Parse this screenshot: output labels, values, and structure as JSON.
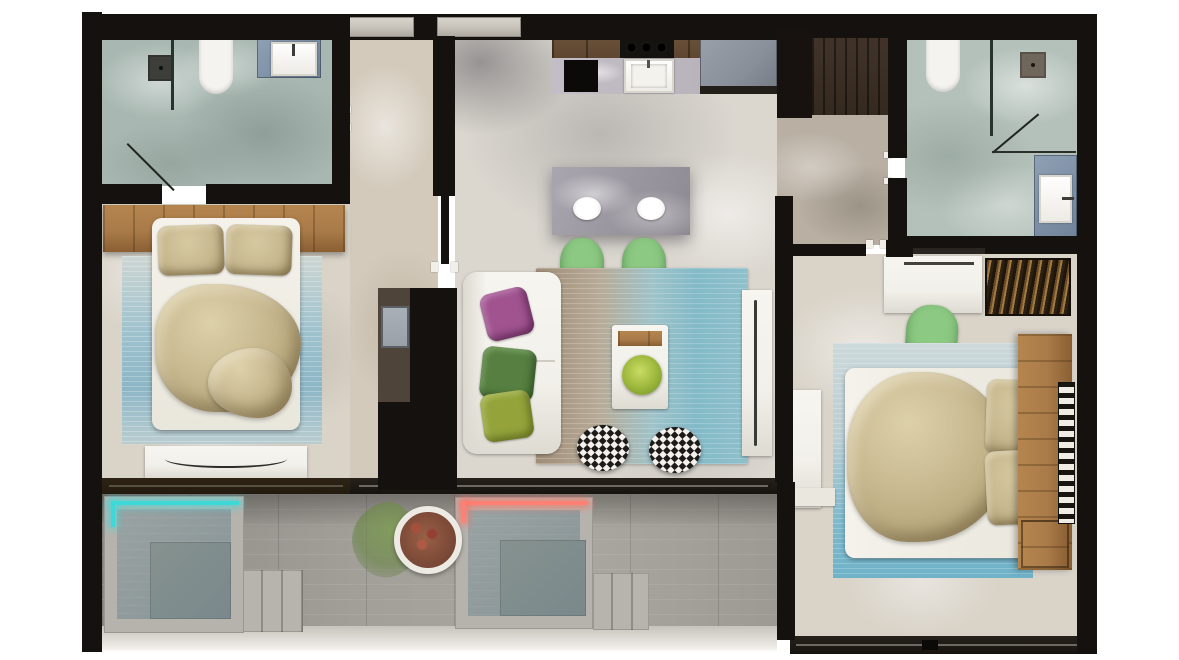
{
  "title": "Two-bedroom apartment floor plan — top-down 3D render",
  "palette": {
    "wall": "#15110e",
    "window": "#c6c2b9",
    "marble_bath": "#a8b7b1",
    "marble_bath2": "#b4c1ba",
    "marble_beige": "#d3cabb",
    "marble_hall2": "#b9b0a3",
    "marble_light": "#dbd7cf",
    "marble_warm": "#d9d3c8",
    "closet_floor": "#4e443a",
    "wood": "#a97b49",
    "wood_dark": "#352a1f",
    "cab_wood": "#5d4530",
    "island": "#9b97a0",
    "counter": "#b9b4bc",
    "fridge": "#8a9099",
    "deck": "#a3a09a",
    "concrete": "#c6c3bc",
    "pit": "#8e999b",
    "pit_core": "#7a888c",
    "led_teal": "#3fd8d8",
    "led_red": "#ff8074",
    "sofa": "#f1efe9",
    "khaki": "#c7b88f",
    "khaki_deep": "#b3a276",
    "rug_blue": "#9fc2ce",
    "rug_taupe": "#a08d78",
    "rug_teal": "#84bac8",
    "pillow_purple": "#a0538f",
    "pillow_green": "#567f41",
    "pillow_olive": "#94a43b",
    "chair_green": "#8cc983",
    "plant_green": "#7e9a55",
    "plant_pot_soil": "#7c4a38",
    "white_furn": "#f2f0ea",
    "pattern_dark": "#1c1b19",
    "slider_wood": "#241b10",
    "slider_dark": "#17130f",
    "appliance_gray": "#9aa0a8"
  },
  "rooms": [
    {
      "id": "bathroom-1",
      "name": "Bathroom 1 (top left)",
      "items": [
        "walk-in shower with floor drain",
        "glass shower screen",
        "wall-hung toilet",
        "blue-stone vanity with white sink",
        "inward door swing"
      ]
    },
    {
      "id": "entry-hall",
      "name": "Entry hallway",
      "items": [
        "beige marble floor",
        "window to outside",
        "utility closet with gray appliance",
        "door opening to living area",
        "door opening to bathroom 1"
      ]
    },
    {
      "id": "kitchen",
      "name": "Kitchen",
      "items": [
        "dark wood upper counter",
        "cooktop with 3 burners",
        "black oven / range",
        "inset white sink",
        "refrigerator",
        "tall black pantry unit",
        "dark wood wardrobe",
        "gray marble island breakfast bar",
        "2 white place settings",
        "2 green bar chairs"
      ]
    },
    {
      "id": "living-room",
      "name": "Living room",
      "items": [
        "white 3-seat sofa",
        "purple accent pillow",
        "green accent pillow",
        "olive accent pillow",
        "taupe-to-teal area rug",
        "white coffee table with wood tray and green plant",
        "2 black-and-white diamond-pattern poufs",
        "white media sideboard"
      ]
    },
    {
      "id": "bedroom-1",
      "name": "Bedroom 1 (left)",
      "items": [
        "full-width wood headboard panel",
        "double bed with white base",
        "2 khaki pillows",
        "crumpled khaki duvet",
        "blue woven rug",
        "white dresser with curved handle"
      ]
    },
    {
      "id": "hallway-2",
      "name": "Hallway 2 (right wing)",
      "items": [
        "marble floor",
        "door opening to bathroom 2",
        "door opening to bedroom 2"
      ]
    },
    {
      "id": "bathroom-2",
      "name": "Bathroom 2 (top right)",
      "items": [
        "wall-hung toilet",
        "shower area with floor drain",
        "glass screen",
        "blue-stone vanity with white sink",
        "door swing"
      ]
    },
    {
      "id": "bedroom-2",
      "name": "Bedroom 2 (right)",
      "items": [
        "white desk",
        "green chair",
        "dark patterned decorative rug",
        "double bed laid horizontally",
        "2 khaki pillows",
        "crumpled khaki duvet",
        "vertical wood headboard panel",
        "wood nightstand",
        "blue woven rug",
        "white wall console",
        "black-and-white patterned runner"
      ]
    },
    {
      "id": "terrace",
      "name": "Terrace (bottom)",
      "items": [
        "gray wood plank deck",
        "sunken lounge pit with teal LED strip",
        "sunken lounge pit with red LED strip",
        "two sets of concrete steps",
        "potted plant with green foliage",
        "sliding glass door track"
      ]
    }
  ]
}
